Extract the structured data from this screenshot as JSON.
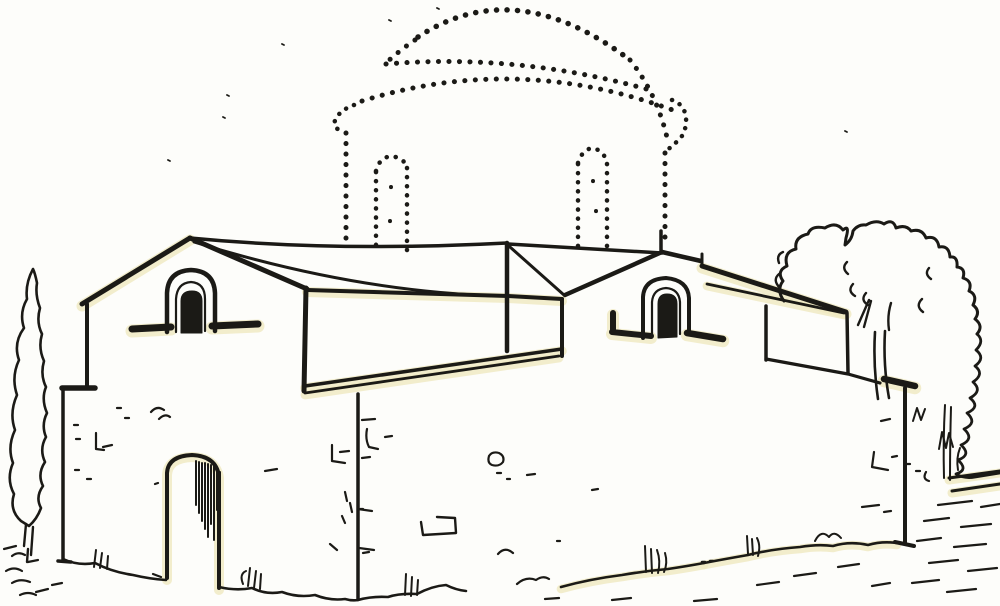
{
  "meta": {
    "description": "Black ink line sketch of a Byzantine cross-plan church seen in perspective: gabled west front with arched gable window and arched doorway, long lower roofs meeting at a central crossing, east gable with arched window, and a reconstructed dome with drum and two arched drum windows drawn entirely in dotted lines above the crossing. A tall cypress stands at far left, a large deciduous tree and low scrub at right, rough grass and stone ground line along the bottom."
  },
  "palette": {
    "paper": "#fdfdfa",
    "ink": "#1b1a16",
    "tint": "#efe9c0"
  },
  "canvas": {
    "width": 1000,
    "height": 606
  },
  "drawing": {
    "dot_style": {
      "width": 5,
      "dash": "0.1 10.4"
    },
    "solid": [
      {
        "id": "gable-left-slope",
        "d": "M82,304 L190,238",
        "w": 5,
        "glow": true
      },
      {
        "id": "gable-right-slope",
        "d": "M190,238 L307,289",
        "w": 5
      },
      {
        "id": "ridge-left",
        "d": "M190,238 Q335,252 507,243",
        "w": 3.5
      },
      {
        "id": "valley-left",
        "d": "M194,242 Q355,292 500,296",
        "w": 3
      },
      {
        "id": "left-wall-upper-edge",
        "d": "M87,304 L87,387",
        "w": 4
      },
      {
        "id": "left-wall-step",
        "d": "M62,388 L95,388",
        "w": 5.5
      },
      {
        "id": "left-wall-lower-edge",
        "d": "M63,388 L63,560 M58,561 L71,562",
        "w": 3.5
      },
      {
        "id": "left-gable-window-outer",
        "d": "M167,332 L167,293 Q168,271 191,270 Q214,271 215,293 L215,331",
        "w": 4.5
      },
      {
        "id": "left-gable-window-inner",
        "d": "M176,332 L176,299 Q177,283 191,282 Q205,283 205,299 L205,331",
        "w": 2.2
      },
      {
        "id": "left-gable-window-core",
        "d": "M181,333 L181,301 Q181,291 192,291 Q202,291 202,301 L202,333 Z",
        "w": 1,
        "fill": true
      },
      {
        "id": "left-sill-left-bar",
        "d": "M132,329 L171,327",
        "w": 7,
        "glow": true
      },
      {
        "id": "left-sill-right-bar",
        "d": "M212,326 L258,324",
        "w": 7,
        "glow": true
      },
      {
        "id": "door-arch",
        "d": "M167,578 L167,473 Q168,456 192,455 Q216,456 219,476 L219,588",
        "w": 4,
        "glow": true
      },
      {
        "id": "door-hatching",
        "d": "M196,461 L196,505 M199,462 L199,513 M202,463 L202,521 M205,463 L205,529 M208,464 L208,537 M211,465 L211,524 M214,466 L214,540 M217,469 L217,510 M220,472 L220,538",
        "w": 2
      },
      {
        "id": "central-crossing-post",
        "d": "M507,243 L507,351",
        "w": 4.5
      },
      {
        "id": "ridge-right",
        "d": "M508,244 L662,253",
        "w": 3.5
      },
      {
        "id": "valley-right",
        "d": "M510,247 L564,295",
        "w": 3
      },
      {
        "id": "front-eave",
        "d": "M307,290 L508,296 L562,299",
        "w": 4,
        "glow": true
      },
      {
        "id": "southwest-corner-post",
        "d": "M306,288 L304,391",
        "w": 5
      },
      {
        "id": "fascia-top-line",
        "d": "M305,386 L562,349",
        "w": 3.5,
        "glow": true
      },
      {
        "id": "fascia-bottom-line",
        "d": "M305,393 L559,356",
        "w": 2.8,
        "glow": true
      },
      {
        "id": "fascia-right-post",
        "d": "M562,299 L562,356",
        "w": 4
      },
      {
        "id": "center-wall-corner",
        "d": "M358,394 L358,599",
        "w": 3.5
      },
      {
        "id": "center-corner-ticks",
        "d": "M358,509 L372,511 M359,548 L374,550",
        "w": 2.2
      },
      {
        "id": "right-gable-left-slope",
        "d": "M662,252 L565,295",
        "w": 4.5
      },
      {
        "id": "right-gable-right-slope",
        "d": "M662,252 L701,261",
        "w": 4.5
      },
      {
        "id": "right-gable-step",
        "d": "M702,254 L702,266",
        "w": 3
      },
      {
        "id": "right-gable-finial",
        "d": "M661,250 L661,231",
        "w": 3.5
      },
      {
        "id": "right-eave",
        "d": "M702,266 L846,312",
        "w": 5,
        "glow": true
      },
      {
        "id": "annex-fascia-lower",
        "d": "M707,284 L844,313",
        "w": 2.8,
        "glow": true
      },
      {
        "id": "annex-left-post",
        "d": "M766,306 L766,360",
        "w": 3.5
      },
      {
        "id": "annex-bottom-edge",
        "d": "M766,359 L848,374 L880,383",
        "w": 3.2
      },
      {
        "id": "annex-right-post",
        "d": "M847,313 L848,373",
        "w": 3.5
      },
      {
        "id": "right-eave-bar",
        "d": "M884,379 L915,386",
        "w": 6.5,
        "glow": true
      },
      {
        "id": "right-wall-corner",
        "d": "M905,388 L905,543 M895,542 L914,546",
        "w": 4
      },
      {
        "id": "right-gable-window-outer",
        "d": "M643,338 L643,297 Q644,279 666,278 Q688,280 689,298 L689,333",
        "w": 4
      },
      {
        "id": "right-gable-window-inner",
        "d": "M652,337 L652,302 Q653,289 666,288 Q679,289 680,302 L680,334",
        "w": 2.2
      },
      {
        "id": "right-gable-window-core",
        "d": "M658,338 L658,304 Q658,294 667,294 Q677,294 677,304 L677,337 Z",
        "w": 1,
        "fill": true
      },
      {
        "id": "right-sill-left-bar",
        "d": "M613,313 L613,331 M612,332 L651,336",
        "w": 6,
        "glow": true
      },
      {
        "id": "right-sill-right-bar",
        "d": "M687,333 L723,339",
        "w": 6.5,
        "glow": true
      },
      {
        "id": "cypress-outline",
        "d": "M33,269 Q25,284 27,299 Q19,313 24,328 Q13,343 19,360 Q11,377 17,395 Q9,413 15,430 Q7,447 13,463 Q6,479 14,494 Q9,510 21,521 L29,526 Q37,519 41,508 Q35,497 43,486 Q37,474 45,462 Q39,449 46,437 Q41,425 47,413 Q41,399 46,387 Q40,375 44,361 Q38,348 42,334 Q36,322 40,308 Q35,295 37,283 Q35,273 33,269 Z",
        "w": 2.6
      },
      {
        "id": "cypress-trunk",
        "d": "M26,524 L24,546 M33,527 L31,555 M28,549 L27,562",
        "w": 2.4
      },
      {
        "id": "tree-canopy-outline",
        "d": "M784,301 Q776,290 783,281 Q776,271 787,266 Q783,252 796,249 Q794,237 808,234 Q811,225 825,228 Q836,221 843,230 Q850,224 846,238 L845,245 Q852,240 853,231 Q858,224 866,225 Q876,219 884,224 Q893,218 896,228 Q906,224 911,231 Q922,228 926,238 Q937,235 939,247 Q949,245 950,257 Q958,256 957,267 Q966,268 963,278 Q973,281 969,291 Q978,295 973,305 Q981,311 975,319 Q984,326 977,334",
        "w": 3
      },
      {
        "id": "tree-bush-right-edge",
        "d": "M977,334 Q985,341 976,350 Q986,358 975,366 Q985,374 973,382 Q983,391 970,398 Q981,407 967,413 Q978,423 964,429 Q975,439 961,445 Q972,455 958,460 Q969,470 956,474 Q964,479 975,477 L1000,473",
        "w": 2.8
      },
      {
        "id": "tree-canopy-hooks",
        "d": "M783,252 Q776,255 779,263 M779,274 Q772,280 780,288 M847,262 Q841,268 848,274 M853,284 Q847,291 855,296 M866,293 Q860,300 868,305 M922,299 Q915,306 923,312 M929,268 Q924,274 931,279",
        "w": 2.4
      },
      {
        "id": "tree-branches",
        "d": "M858,325 L869,300 M871,301 L864,327 M891,303 Q887,316 889,330",
        "w": 2.4
      },
      {
        "id": "tree-trunk",
        "d": "M875,332 Q873,365 878,399 M885,331 Q883,365 889,398",
        "w": 2.6
      },
      {
        "id": "bush-zigzag-marks",
        "d": "M913,421 L917,408 L921,420 L925,409 M939,449 L942,432 L946,448 L949,433 L953,447",
        "w": 2
      },
      {
        "id": "bush-stem-strokes",
        "d": "M945,405 Q943,440 944,478 M951,407 Q950,442 950,480 M958,470 Q956,458 960,448",
        "w": 2
      },
      {
        "id": "right-low-wall-lines",
        "d": "M949,478 L1000,471 M952,491 L1000,484",
        "w": 3,
        "glow": true
      },
      {
        "id": "right-ground-dashes",
        "d": "M938,505 L972,501 M981,507 L1000,504 M924,521 L949,518 M961,527 L991,524 M917,541 L941,538 M954,547 L986,544 M929,563 L958,560 M968,571 L997,568 M912,583 L939,580 M947,592 L976,589",
        "w": 2.2
      },
      {
        "id": "ground-left-rocks",
        "d": "M4,549 L16,546 M12,556 Q18,551 25,555 M6,571 Q14,566 22,571 M28,562 L38,560 M12,583 Q20,578 30,582 M36,592 L48,589 M20,595 Q28,591 36,595 M52,585 L62,583",
        "w": 2.2
      },
      {
        "id": "base-left-wall",
        "d": "M63,559 Q78,566 95,563 Q112,572 133,575 Q150,579 166,580",
        "w": 2.6
      },
      {
        "id": "grass-left",
        "d": "M96,550 L94,567 M102,553 L100,568 M108,556 L107,569",
        "w": 2
      },
      {
        "id": "base-door-to-corner",
        "d": "M219,587 Q236,591 252,588 Q266,595 282,592 Q298,598 315,595 Q330,601 345,599 Q352,601 358,600",
        "w": 2.6
      },
      {
        "id": "grass-by-door",
        "d": "M248,586 L250,568 M254,588 L256,571 M260,589 L261,574 M243,584 Q239,574 246,571",
        "w": 2
      },
      {
        "id": "base-center-wall",
        "d": "M358,600 Q372,596 388,597 Q400,593 417,594 Q432,586 446,585 Q456,590 466,591",
        "w": 2.6
      },
      {
        "id": "grass-center",
        "d": "M405,595 L406,574 M411,596 L412,577 M417,595 L418,580",
        "w": 2
      },
      {
        "id": "mid-ground-squiggles",
        "d": "M498,554 Q505,546 513,553 M517,584 Q526,576 536,580 Q543,575 549,579",
        "w": 2.2
      },
      {
        "id": "base-long",
        "d": "M561,587 Q590,579 622,575 Q645,571 668,569 Q688,566 704,563",
        "w": 2.6,
        "glow": true
      },
      {
        "id": "grass-tall",
        "d": "M646,572 L645,546 M652,573 L651,549 M658,573 Q661,561 657,550 M664,572 Q668,563 665,553",
        "w": 2
      },
      {
        "id": "base-dot-pair",
        "d": "M702,562 L705,562 M710,561 L713,561",
        "w": 2.5
      },
      {
        "id": "base-right",
        "d": "M704,563 Q725,559 748,555 Q772,549 800,547 Q818,544 833,546 Q850,541 868,545 Q882,541 897,543",
        "w": 2.6,
        "glow": true
      },
      {
        "id": "grass-right",
        "d": "M748,554 L747,536 M753,555 L752,539 M758,556 Q761,546 757,538 M815,541 Q821,529 829,537 Q834,530 841,538",
        "w": 2
      },
      {
        "id": "under-base-dashes",
        "d": "M545,599 L559,598 M612,600 L631,598 M694,601 L717,599 M757,585 L779,582 M794,576 L816,573 M838,567 L859,564 M872,586 L890,583",
        "w": 2.2
      },
      {
        "id": "left-wall-stone-marks",
        "d": "M117,408 L121,408 M125,418 L129,418 M151,412 Q157,405 164,410 M159,419 Q165,413 170,417 M103,447 L112,445 M96,433 L96,449 M96,449 L104,450 M74,425 L78,425 M76,439 L80,439 M75,470 L79,470 M87,479 L91,479 M155,484 L158,483 M153,574 L161,577",
        "w": 2.2
      },
      {
        "id": "left-wall-stone-marks-2",
        "d": "M265,471 L277,469 M332,445 L332,461 M332,461 L345,463 M340,452 L349,451 M345,492 L347,501 M350,503 L352,512 M342,516 L345,523 M330,544 L337,550",
        "w": 2.2
      },
      {
        "id": "center-wall-stone-marks",
        "d": "M362,420 L375,419 M367,429 Q365,439 369,447 M369,447 L378,449 M385,437 L392,436 M362,458 L370,457 M360,509 L363,509 M363,553 L369,552",
        "w": 2.2
      },
      {
        "id": "center-wall-stone-block",
        "d": "M489,456 Q487,463 492,465 Q499,467 503,462 Q505,456 499,453 Q492,451 489,456 M497,473 L501,473 M507,479 L510,479 M527,475 L535,474",
        "w": 2.2
      },
      {
        "id": "center-wall-stone-rect",
        "d": "M421,522 L423,535 L456,533 L455,518 L437,517",
        "w": 2.4
      },
      {
        "id": "center-wall-dots",
        "d": "M557,541 L560,541 M592,490 L598,489",
        "w": 2.2
      },
      {
        "id": "right-wall-stone-marks",
        "d": "M874,452 L872,467 M872,467 L888,470 M892,457 L897,456 M862,507 L879,505 M884,512 L891,511 M881,421 L890,419 M906,464 L910,464 M916,471 L920,471 M926,472 Q922,479 929,481",
        "w": 2.2
      },
      {
        "id": "paper-specks",
        "d": "M282,44 L284,45 M227,95 L229,96 M223,117 L225,118 M168,160 L170,161 M389,20 L391,21 M437,8 L439,9 M845,131 L847,132",
        "w": 1.8
      }
    ],
    "dotted": [
      {
        "id": "dome-cap-dotted",
        "d": "M418,37 Q515,-27 630,60",
        "w": 5.5
      },
      {
        "id": "dome-left-shoulder-dotted",
        "d": "M415,40 Q400,50 386,63",
        "w": 5
      },
      {
        "id": "drum-cornice-upper-dotted",
        "d": "M386,64 Q518,53 650,90",
        "w": 5
      },
      {
        "id": "dome-right-shoulder-dotted",
        "d": "M630,60 Q658,95 668,142",
        "w": 5
      },
      {
        "id": "drum-cornice-lower-dotted",
        "d": "M362,101 Q520,52 678,112",
        "w": 5
      },
      {
        "id": "cornice-curl-left-dotted",
        "d": "M354,105 Q340,110 335,120 Q333,130 344,131",
        "w": 4.5,
        "dash": "0.1 8.5"
      },
      {
        "id": "cornice-curl-right-dotted",
        "d": "M672,100 Q684,104 686,117 Q687,132 678,141 Q671,146 667,151",
        "w": 4.5,
        "dash": "0.1 8.5"
      },
      {
        "id": "drum-left-edge-dotted",
        "d": "M346,133 L346,247",
        "w": 5
      },
      {
        "id": "drum-right-edge-dotted",
        "d": "M665,153 L665,247",
        "w": 5
      },
      {
        "id": "drum-window-left-l-dotted",
        "d": "M376,172 L376,249",
        "w": 4.5,
        "dash": "0.1 9"
      },
      {
        "id": "drum-window-left-r-dotted",
        "d": "M407,168 L407,250",
        "w": 4.5,
        "dash": "0.1 9"
      },
      {
        "id": "drum-window-left-arch-dotted",
        "d": "M376,171 Q379,158 391,156 Q404,158 407,167",
        "w": 4.5,
        "dash": "0.1 9"
      },
      {
        "id": "drum-window-right-l-dotted",
        "d": "M578,164 L578,246",
        "w": 4.5,
        "dash": "0.1 9"
      },
      {
        "id": "drum-window-right-r-dotted",
        "d": "M607,164 L607,247",
        "w": 4.5,
        "dash": "0.1 9"
      },
      {
        "id": "drum-window-right-arch-dotted",
        "d": "M578,163 Q582,150 592,148 Q604,150 607,163",
        "w": 4.5,
        "dash": "0.1 9"
      },
      {
        "id": "drum-inner-dots",
        "d": "M391,187 L391,188 M593,181 L593,182 M596,211 L596,212 M390,221 L390,222",
        "w": 4,
        "dash": "0.1 16"
      }
    ]
  }
}
